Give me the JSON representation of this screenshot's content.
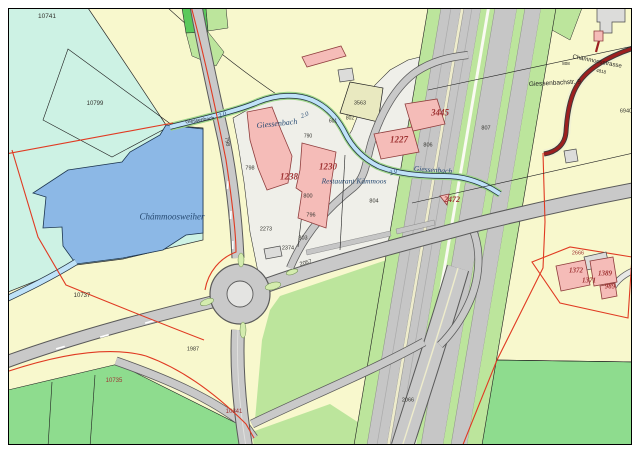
{
  "map": {
    "colors": {
      "base": "#f8f8cd",
      "wetland": "#cdf2e4",
      "lake": "#8cb8e6",
      "lightgreen": "#bce59c",
      "midgreen": "#8edc8e",
      "darkgreen": "#5bc95b",
      "urban": "#efefe9",
      "beige": "#e9e9c0",
      "rail": "#c6c6c6",
      "cream": "#eeeccc",
      "road": "#c9c9c9",
      "roadcase": "#5a5a5a",
      "bldg": "#f5bcb8",
      "bldgline": "#8f3d3d",
      "graybldg": "#dcdcda",
      "red": "#e03a22",
      "maroon": "#9c1f1f",
      "stream": "#bfe2f8"
    },
    "labels": [
      {
        "text": "10741",
        "x": 47,
        "y": 17,
        "kind": "p",
        "size": 6.5,
        "rot": 0
      },
      {
        "text": "10799",
        "x": 95,
        "y": 104,
        "kind": "p",
        "size": 6,
        "rot": 0
      },
      {
        "text": "Giessenbach",
        "x": 200,
        "y": 121,
        "kind": "st",
        "size": 5,
        "rot": -8
      },
      {
        "text": "2.0",
        "x": 223,
        "y": 116,
        "kind": "w",
        "size": 6.5,
        "rot": -25
      },
      {
        "text": "Giessenbach",
        "x": 277,
        "y": 124,
        "kind": "w",
        "size": 8,
        "rot": -6
      },
      {
        "text": "2.0",
        "x": 305,
        "y": 116,
        "kind": "w",
        "size": 6.5,
        "rot": -20
      },
      {
        "text": "798",
        "x": 226,
        "y": 142,
        "kind": "p",
        "size": 5.5,
        "rot": 80
      },
      {
        "text": "798",
        "x": 250,
        "y": 169,
        "kind": "p",
        "size": 5.5,
        "rot": 0
      },
      {
        "text": "1238",
        "x": 289,
        "y": 177,
        "kind": "b",
        "size": 9,
        "rot": 0
      },
      {
        "text": "1230",
        "x": 328,
        "y": 167,
        "kind": "b",
        "size": 9,
        "rot": 0
      },
      {
        "text": "Restaurant Kämmoos",
        "x": 354,
        "y": 181,
        "kind": "w",
        "size": 7.5,
        "rot": 0
      },
      {
        "text": "800",
        "x": 308,
        "y": 197,
        "kind": "p",
        "size": 5.5,
        "rot": 0
      },
      {
        "text": "796",
        "x": 311,
        "y": 216,
        "kind": "p",
        "size": 5.5,
        "rot": 0
      },
      {
        "text": "2273",
        "x": 266,
        "y": 230,
        "kind": "p",
        "size": 5.5,
        "rot": 0
      },
      {
        "text": "803",
        "x": 303,
        "y": 239,
        "kind": "p",
        "size": 5.5,
        "rot": 0
      },
      {
        "text": "2374",
        "x": 288,
        "y": 249,
        "kind": "p",
        "size": 5.5,
        "rot": 0
      },
      {
        "text": "2057",
        "x": 306,
        "y": 264,
        "kind": "p",
        "size": 5.5,
        "rot": -14
      },
      {
        "text": "804",
        "x": 374,
        "y": 202,
        "kind": "p",
        "size": 5.5,
        "rot": 0
      },
      {
        "text": "806",
        "x": 428,
        "y": 146,
        "kind": "p",
        "size": 5.5,
        "rot": 0
      },
      {
        "text": "3563",
        "x": 360,
        "y": 104,
        "kind": "p",
        "size": 5.5,
        "rot": 0
      },
      {
        "text": "802",
        "x": 350,
        "y": 119,
        "kind": "p",
        "size": 5,
        "rot": 0
      },
      {
        "text": "601",
        "x": 333,
        "y": 122,
        "kind": "p",
        "size": 5,
        "rot": 0
      },
      {
        "text": "790",
        "x": 308,
        "y": 137,
        "kind": "p",
        "size": 5,
        "rot": 0
      },
      {
        "text": "3445",
        "x": 440,
        "y": 113,
        "kind": "b",
        "size": 9,
        "rot": 0
      },
      {
        "text": "1227",
        "x": 399,
        "y": 140,
        "kind": "b",
        "size": 9,
        "rot": 0
      },
      {
        "text": "Giessenbach",
        "x": 433,
        "y": 170,
        "kind": "w",
        "size": 7.5,
        "rot": 4
      },
      {
        "text": "2.0",
        "x": 394,
        "y": 173,
        "kind": "w",
        "size": 6.5,
        "rot": -25
      },
      {
        "text": "807",
        "x": 486,
        "y": 129,
        "kind": "p",
        "size": 5.5,
        "rot": 0
      },
      {
        "text": "2472",
        "x": 452,
        "y": 200,
        "kind": "b",
        "size": 8,
        "rot": 0
      },
      {
        "text": "Giessenbachstr. 9",
        "x": 555,
        "y": 84,
        "kind": "st",
        "size": 6.5,
        "rot": -3
      },
      {
        "text": "Chämmoosstrasse",
        "x": 597,
        "y": 62,
        "kind": "st",
        "size": 6,
        "rot": 11
      },
      {
        "text": "4818",
        "x": 601,
        "y": 72,
        "kind": "st",
        "size": 4.5,
        "rot": 11
      },
      {
        "text": "808",
        "x": 566,
        "y": 64,
        "kind": "st",
        "size": 4.5,
        "rot": 0
      },
      {
        "text": "6940",
        "x": 626,
        "y": 112,
        "kind": "p",
        "size": 5.5,
        "rot": 0
      },
      {
        "text": "Chámmoosweiher",
        "x": 172,
        "y": 217,
        "kind": "w",
        "size": 9,
        "rot": 0
      },
      {
        "text": "10737",
        "x": 82,
        "y": 296,
        "kind": "p",
        "size": 6,
        "rot": 0
      },
      {
        "text": "10735",
        "x": 114,
        "y": 381,
        "kind": "pr",
        "size": 6,
        "rot": 0
      },
      {
        "text": "10841",
        "x": 234,
        "y": 412,
        "kind": "pr",
        "size": 6,
        "rot": 0
      },
      {
        "text": "1987",
        "x": 193,
        "y": 350,
        "kind": "p",
        "size": 5.5,
        "rot": 0
      },
      {
        "text": "2066",
        "x": 408,
        "y": 401,
        "kind": "p",
        "size": 5.5,
        "rot": 0
      },
      {
        "text": "2666",
        "x": 578,
        "y": 254,
        "kind": "pr",
        "size": 5.5,
        "rot": 0
      },
      {
        "text": "1372",
        "x": 576,
        "y": 271,
        "kind": "b",
        "size": 7,
        "rot": 0
      },
      {
        "text": "1371",
        "x": 589,
        "y": 281,
        "kind": "b",
        "size": 7,
        "rot": 0
      },
      {
        "text": "1389",
        "x": 605,
        "y": 274,
        "kind": "b",
        "size": 7,
        "rot": 0
      },
      {
        "text": "989",
        "x": 610,
        "y": 287,
        "kind": "b",
        "size": 7,
        "rot": 0
      }
    ]
  }
}
